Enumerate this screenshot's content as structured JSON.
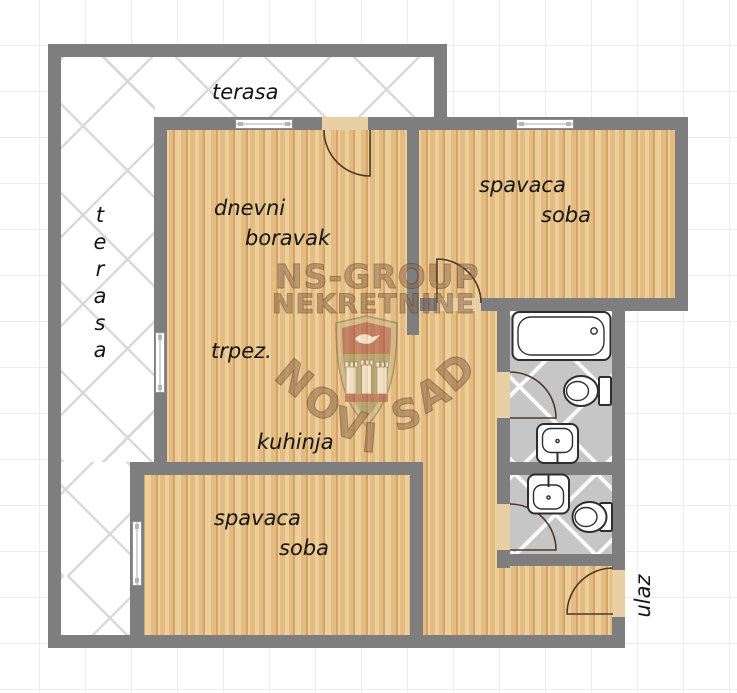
{
  "rooms": {
    "terrace_top": "terasa",
    "terrace_side": "terasa",
    "living": {
      "line1": "dnevni",
      "line2": "boravak"
    },
    "dining": "trpez.",
    "kitchen": "kuhinja",
    "bedroom_top": {
      "line1": "spavaca",
      "line2": "soba"
    },
    "bedroom_bottom": {
      "line1": "spavaca",
      "line2": "soba"
    },
    "entrance": "ulaz"
  },
  "watermark": {
    "agency_line1": "NS-GROUP",
    "agency_line2": "NEKRETNINE",
    "city": "NOVI SAD"
  },
  "colors": {
    "wall": "#7e7e7e",
    "wood_light": "#eccf9b",
    "wood_mid": "#e4bc81",
    "wood_dark": "#d3a468",
    "tile": "#c6c6c6",
    "terrace_line": "#d9d9d9",
    "door_sill": "#e9d0a4",
    "door_arc": "#4a3a26",
    "grid_line": "#ededed",
    "fixture_outline": "#2e2e2e",
    "watermark_brown": "#8d6749",
    "label_text": "#151515"
  }
}
